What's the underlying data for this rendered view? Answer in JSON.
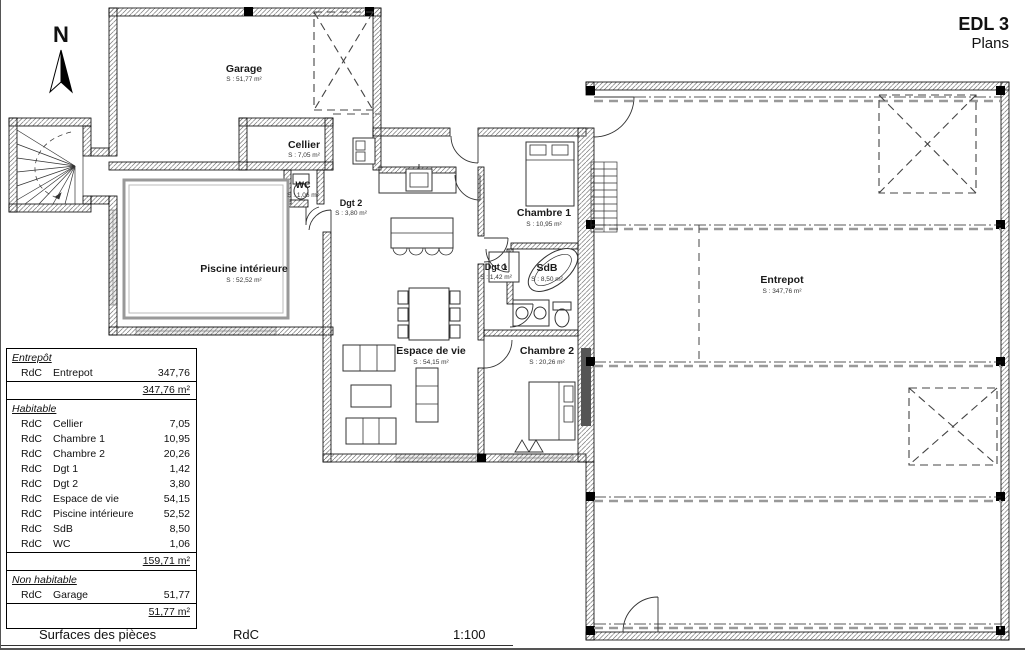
{
  "title": {
    "line1": "EDL 3",
    "line2": "Plans"
  },
  "north_label": "N",
  "rooms": {
    "garage": {
      "name": "Garage",
      "area": "S : 51,77 m²"
    },
    "cellier": {
      "name": "Cellier",
      "area": "S : 7,05 m²"
    },
    "wc": {
      "name": "WC",
      "area": "S : 1,06 m²"
    },
    "dgt2": {
      "name": "Dgt 2",
      "area": "S : 3,80 m²"
    },
    "piscine": {
      "name": "Piscine intérieure",
      "area": "S : 52,52 m²"
    },
    "chambre1": {
      "name": "Chambre 1",
      "area": "S : 10,95 m²"
    },
    "dgt1": {
      "name": "Dgt 1",
      "area": "S : 1,42 m²"
    },
    "sdb": {
      "name": "SdB",
      "area": "S : 8,50 m²"
    },
    "chambre2": {
      "name": "Chambre 2",
      "area": "S : 20,26 m²"
    },
    "espace": {
      "name": "Espace de vie",
      "area": "S : 54,15 m²"
    },
    "entrepot": {
      "name": "Entrepot",
      "area": "S : 347,76 m²"
    }
  },
  "table": {
    "sections": [
      {
        "header": "Entrepôt",
        "rows": [
          {
            "level": "RdC",
            "room": "Entrepot",
            "value": "347,76"
          }
        ],
        "total": "347,76 m²"
      },
      {
        "header": "Habitable",
        "rows": [
          {
            "level": "RdC",
            "room": "Cellier",
            "value": "7,05"
          },
          {
            "level": "RdC",
            "room": "Chambre 1",
            "value": "10,95"
          },
          {
            "level": "RdC",
            "room": "Chambre 2",
            "value": "20,26"
          },
          {
            "level": "RdC",
            "room": "Dgt 1",
            "value": "1,42"
          },
          {
            "level": "RdC",
            "room": "Dgt 2",
            "value": "3,80"
          },
          {
            "level": "RdC",
            "room": "Espace de vie",
            "value": "54,15"
          },
          {
            "level": "RdC",
            "room": "Piscine intérieure",
            "value": "52,52"
          },
          {
            "level": "RdC",
            "room": "SdB",
            "value": "8,50"
          },
          {
            "level": "RdC",
            "room": "WC",
            "value": "1,06"
          }
        ],
        "total": "159,71 m²"
      },
      {
        "header": "Non habitable",
        "rows": [
          {
            "level": "RdC",
            "room": "Garage",
            "value": "51,77"
          }
        ],
        "total": "51,77 m²"
      }
    ]
  },
  "footer": {
    "left": "Surfaces des pièces",
    "center": "RdC",
    "right": "1:100"
  }
}
